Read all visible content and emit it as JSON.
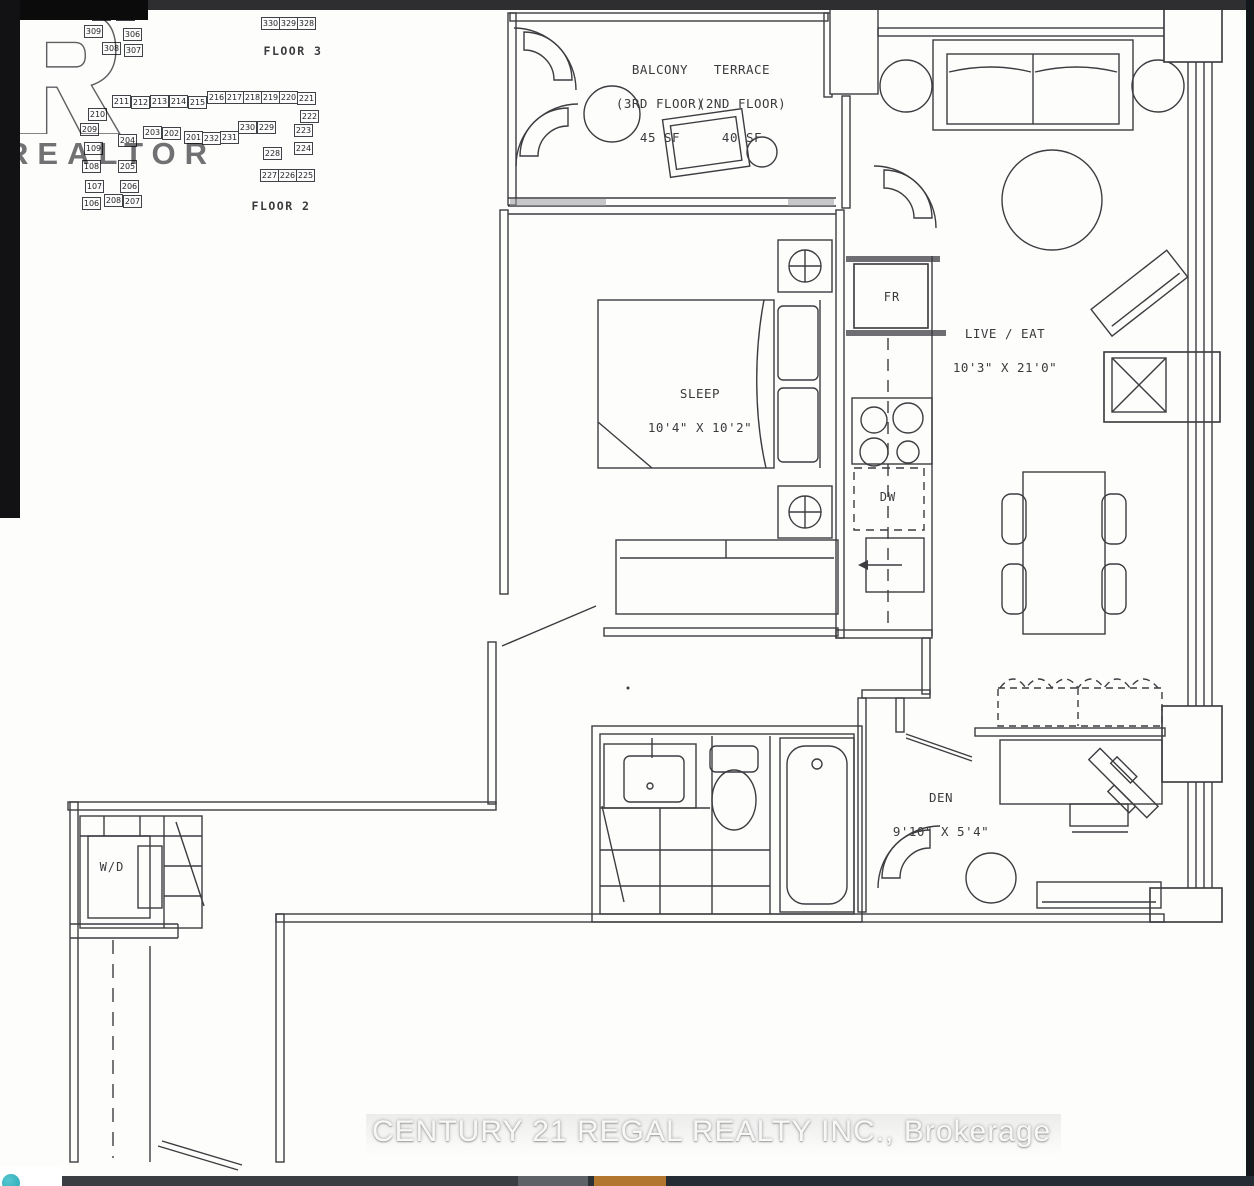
{
  "chrome": {
    "accent_orange": "#b3762e",
    "teal_icon_color": "#2aa8b5"
  },
  "watermarks": {
    "realtor_letter": "R",
    "realtor_text": "REALTOR",
    "brokerage": "CENTURY 21 REGAL REALTY INC., Brokerage"
  },
  "keyplan": {
    "clipped_unit": "311",
    "floor3": {
      "label": "FLOOR 3",
      "units": [
        {
          "n": "310",
          "x": 92,
          "y": 8
        },
        {
          "n": "305",
          "x": 116,
          "y": 8
        },
        {
          "n": "309",
          "x": 84,
          "y": 25
        },
        {
          "n": "306",
          "x": 123,
          "y": 28
        },
        {
          "n": "308",
          "x": 102,
          "y": 42
        },
        {
          "n": "307",
          "x": 124,
          "y": 44
        },
        {
          "n": "330",
          "x": 261,
          "y": 17
        },
        {
          "n": "329",
          "x": 279,
          "y": 17
        },
        {
          "n": "328",
          "x": 297,
          "y": 17
        }
      ]
    },
    "floor2": {
      "label": "FLOOR 2",
      "units": [
        {
          "n": "210",
          "x": 88,
          "y": 108
        },
        {
          "n": "211",
          "x": 112,
          "y": 95
        },
        {
          "n": "212",
          "x": 131,
          "y": 96
        },
        {
          "n": "213",
          "x": 150,
          "y": 95
        },
        {
          "n": "214",
          "x": 169,
          "y": 95
        },
        {
          "n": "215",
          "x": 188,
          "y": 96
        },
        {
          "n": "216",
          "x": 207,
          "y": 91
        },
        {
          "n": "217",
          "x": 225,
          "y": 91
        },
        {
          "n": "218",
          "x": 243,
          "y": 91
        },
        {
          "n": "219",
          "x": 261,
          "y": 91
        },
        {
          "n": "220",
          "x": 279,
          "y": 91
        },
        {
          "n": "221",
          "x": 297,
          "y": 92
        },
        {
          "n": "222",
          "x": 300,
          "y": 110
        },
        {
          "n": "209",
          "x": 80,
          "y": 123
        },
        {
          "n": "204",
          "x": 118,
          "y": 134
        },
        {
          "n": "203",
          "x": 143,
          "y": 126
        },
        {
          "n": "202",
          "x": 162,
          "y": 127
        },
        {
          "n": "201",
          "x": 184,
          "y": 131
        },
        {
          "n": "232",
          "x": 202,
          "y": 132
        },
        {
          "n": "231",
          "x": 220,
          "y": 131
        },
        {
          "n": "230",
          "x": 238,
          "y": 121
        },
        {
          "n": "229",
          "x": 257,
          "y": 121
        },
        {
          "n": "223",
          "x": 294,
          "y": 124
        },
        {
          "n": "224",
          "x": 294,
          "y": 142
        },
        {
          "n": "109",
          "x": 84,
          "y": 142
        },
        {
          "n": "228",
          "x": 263,
          "y": 147
        },
        {
          "n": "108",
          "x": 82,
          "y": 160
        },
        {
          "n": "205",
          "x": 118,
          "y": 160
        },
        {
          "n": "227",
          "x": 260,
          "y": 169
        },
        {
          "n": "226",
          "x": 278,
          "y": 169
        },
        {
          "n": "225",
          "x": 296,
          "y": 169
        },
        {
          "n": "107",
          "x": 85,
          "y": 180
        },
        {
          "n": "206",
          "x": 120,
          "y": 180
        },
        {
          "n": "106",
          "x": 82,
          "y": 197
        },
        {
          "n": "208",
          "x": 104,
          "y": 194
        },
        {
          "n": "207",
          "x": 123,
          "y": 195
        }
      ]
    }
  },
  "rooms": {
    "balcony": {
      "name": "BALCONY",
      "note": "(3RD FLOOR)",
      "area": "45 SF"
    },
    "terrace": {
      "name": "TERRACE",
      "note": "(2ND FLOOR)",
      "area": "40 SF"
    },
    "sleep": {
      "name": "SLEEP",
      "dims": "10'4\" X 10'2\""
    },
    "live_eat": {
      "name": "LIVE / EAT",
      "dims": "10'3\" X 21'0\""
    },
    "den": {
      "name": "DEN",
      "dims": "9'10\" X 5'4\""
    },
    "fridge": "FR",
    "dishwasher": "DW",
    "washer_dryer": "W/D"
  }
}
